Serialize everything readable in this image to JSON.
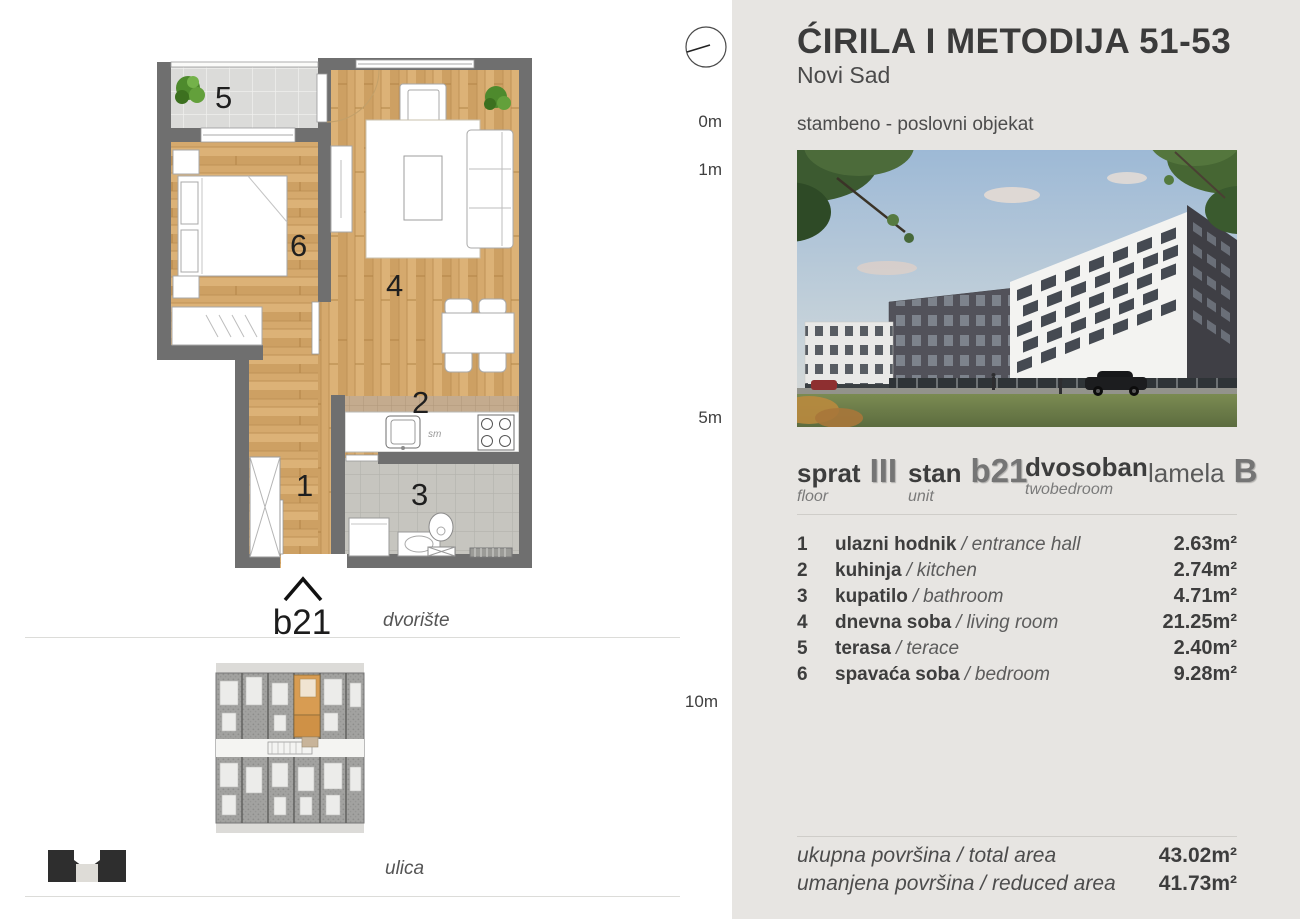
{
  "header": {
    "title": "ĆIRILA I METODIJA 51-53",
    "city": "Novi Sad",
    "building_type": "stambeno - poslovni objekat"
  },
  "ruler": {
    "t0": "0m",
    "t1": "1m",
    "t5": "5m",
    "t10": "10m"
  },
  "floor_plan": {
    "unit_label": "b21",
    "numbers": {
      "n1": "1",
      "n2": "2",
      "n3": "3",
      "n4": "4",
      "n5": "5",
      "n6": "6"
    },
    "kitchen_tag": "sm",
    "courtyard_label": "dvorište",
    "street_label": "ulica"
  },
  "unit_info": {
    "floor_label": "sprat",
    "floor_sublabel": "floor",
    "floor_value": "III",
    "unit_label": "stan",
    "unit_sublabel": "unit",
    "unit_value": "b21",
    "type_label": "dvosoban",
    "type_sublabel": "twobedroom",
    "lamela_label": "lamela",
    "lamela_value": "B"
  },
  "list_separator": "/",
  "rooms": [
    {
      "num": "1",
      "name": "ulazni hodnik",
      "name_en": "entrance hall",
      "area": "2.63m²"
    },
    {
      "num": "2",
      "name": "kuhinja",
      "name_en": "kitchen",
      "area": "2.74m²"
    },
    {
      "num": "3",
      "name": "kupatilo",
      "name_en": "bathroom",
      "area": "4.71m²"
    },
    {
      "num": "4",
      "name": "dnevna soba",
      "name_en": "living room",
      "area": "21.25m²"
    },
    {
      "num": "5",
      "name": "terasa",
      "name_en": "terace",
      "area": "2.40m²"
    },
    {
      "num": "6",
      "name": "spavaća soba",
      "name_en": "bedroom",
      "area": "9.28m²"
    }
  ],
  "totals": [
    {
      "label": "ukupna površina / total area",
      "value": "43.02m²"
    },
    {
      "label": "umanjena površina / reduced area",
      "value": "41.73m²"
    }
  ],
  "colors": {
    "panel_bg": "#e7e5e2",
    "wall": "#6f6f6f",
    "wood": "#d5a96d",
    "unit_highlight": "#d89c52",
    "text_dark": "#3d3d3d",
    "text_gray": "#757575"
  }
}
